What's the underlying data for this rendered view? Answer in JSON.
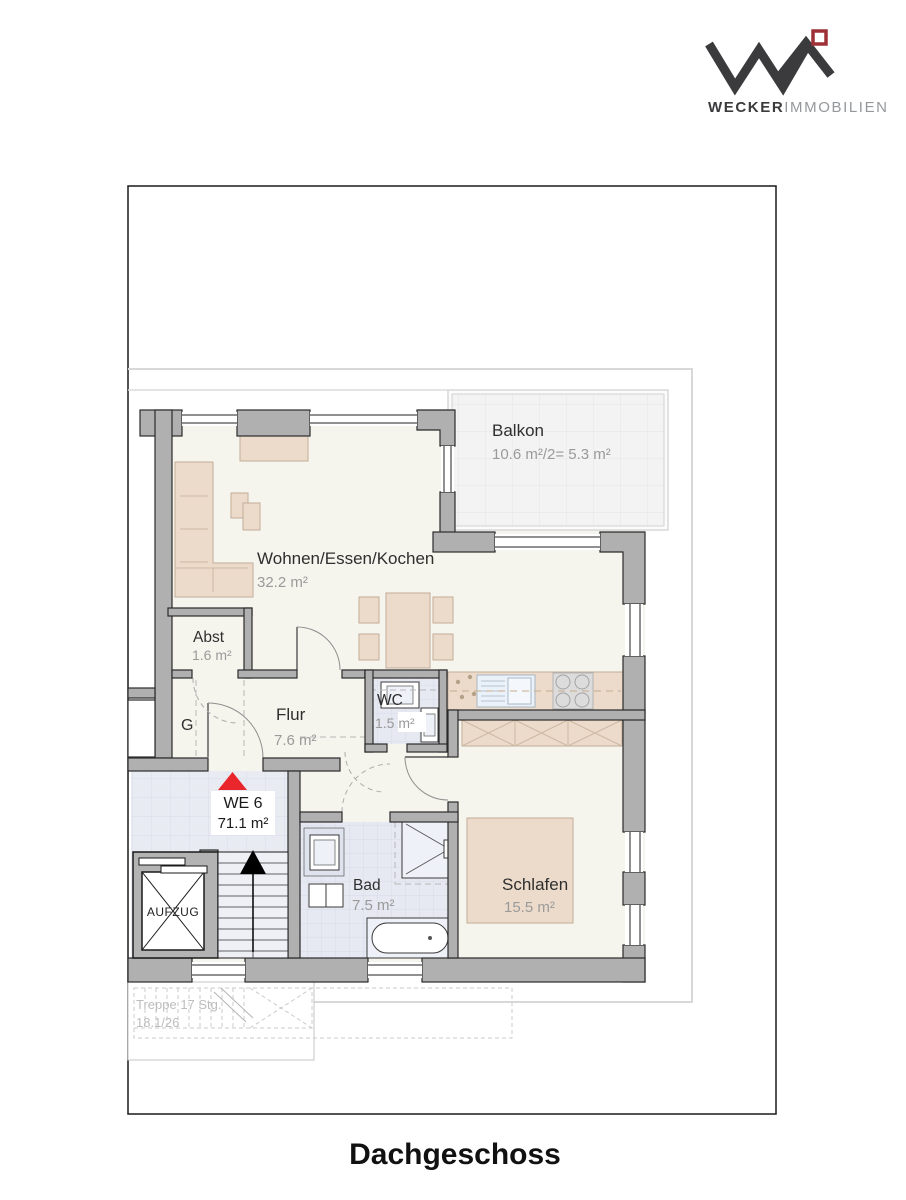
{
  "header": {
    "brand_bold": "WECKER",
    "brand_light": "IMMOBILIEN"
  },
  "plan": {
    "unit_label": "WE 6",
    "unit_area": "71.1 m²",
    "rooms": {
      "wohnen": {
        "name": "Wohnen/Essen/Kochen",
        "area": "32.2 m²"
      },
      "balkon": {
        "name": "Balkon",
        "area": "10.6 m²/2= 5.3 m²"
      },
      "abst": {
        "name": "Abst",
        "area": "1.6 m²"
      },
      "flur": {
        "name": "Flur",
        "area": "7.6 m²"
      },
      "wc": {
        "name": "WC",
        "area": "1.5 m²"
      },
      "bad": {
        "name": "Bad",
        "area": "7.5 m²"
      },
      "schlafen": {
        "name": "Schlafen",
        "area": "15.5 m²"
      }
    },
    "garderobe_label": "G",
    "elevator_label": "AUFZUG",
    "stairs_line1": "Treppe 17 Stg.",
    "stairs_line2": "18.1/26"
  },
  "footer": {
    "floor_title": "Dachgeschoss"
  },
  "colors": {
    "entrance_marker": "#e8262b",
    "logo_red": "#9e3038",
    "logo_dark": "#3b3b3d",
    "wall_gray": "#b0b0b0",
    "furniture_beige": "#ecdbca",
    "tile_blue": "#e7eaf2"
  }
}
